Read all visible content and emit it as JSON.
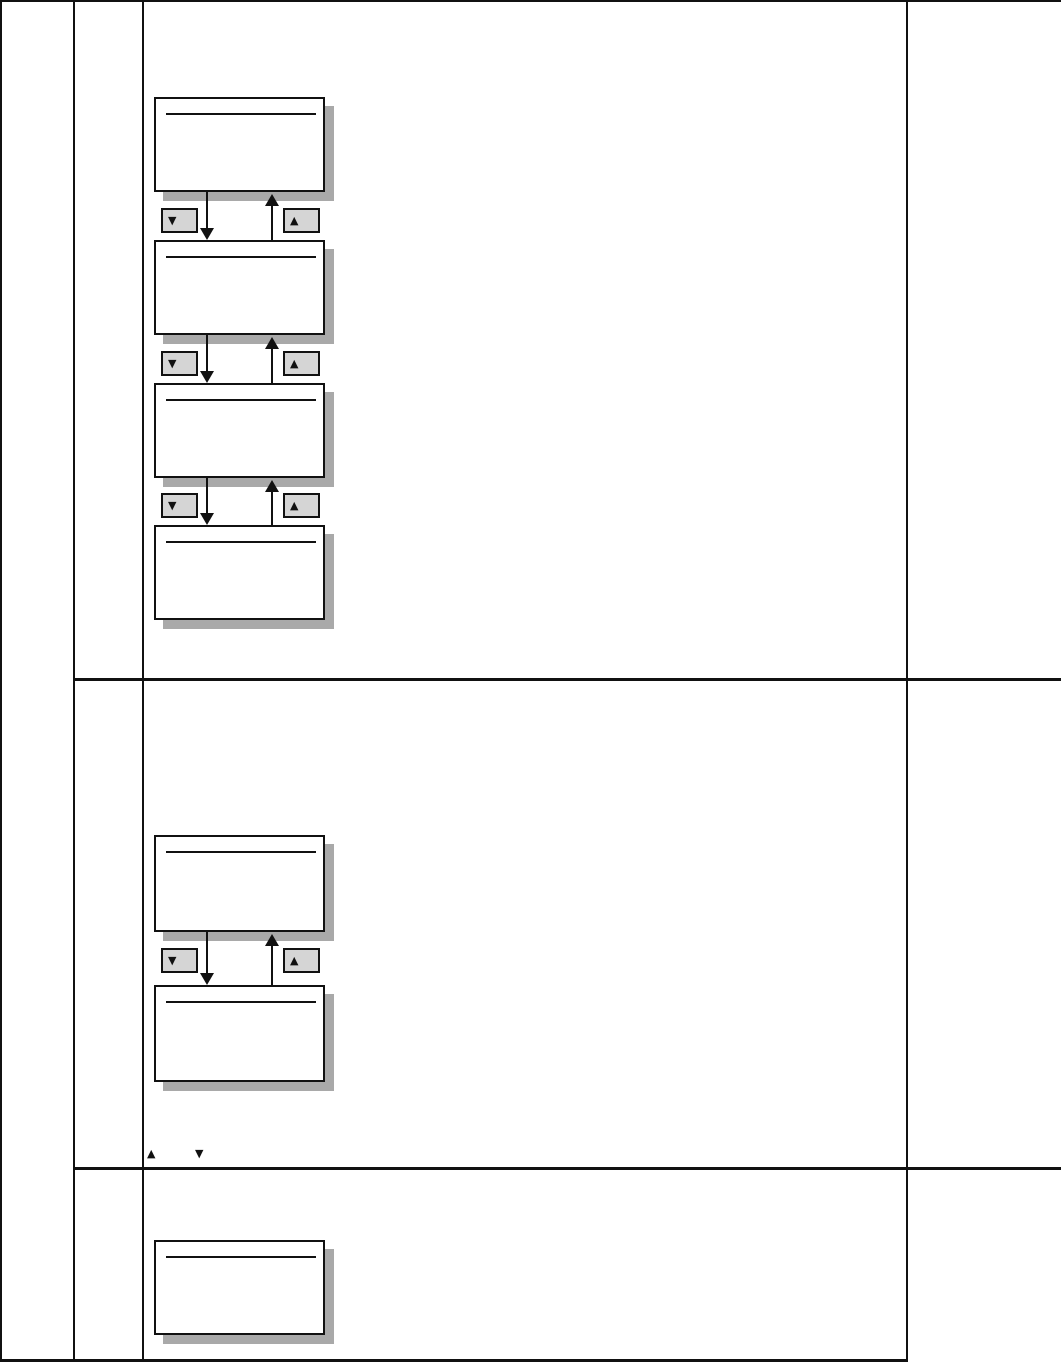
{
  "page": {
    "kind": "manual-page-menu-navigation-diagram",
    "visible_text": ""
  },
  "table": {
    "header_cells": [
      "",
      "",
      "",
      ""
    ],
    "body_rows": 3,
    "columns": 4
  },
  "diagram": {
    "display_panels": [
      {
        "id": 1,
        "text": ""
      },
      {
        "id": 2,
        "text": ""
      },
      {
        "id": 3,
        "text": ""
      },
      {
        "id": 4,
        "text": ""
      },
      {
        "id": 5,
        "text": ""
      },
      {
        "id": 6,
        "text": ""
      },
      {
        "id": 7,
        "text": ""
      }
    ],
    "connector_count": 4
  },
  "icons": {
    "down_key": "▼",
    "up_key": "▲"
  },
  "inline_keys": {
    "up": "▲",
    "down": "▼"
  },
  "colors": {
    "line": "#111111",
    "page_bg": "#ffffff",
    "panel_shadow": "#a9a9a9",
    "button_fill": "#d5d5d5"
  }
}
